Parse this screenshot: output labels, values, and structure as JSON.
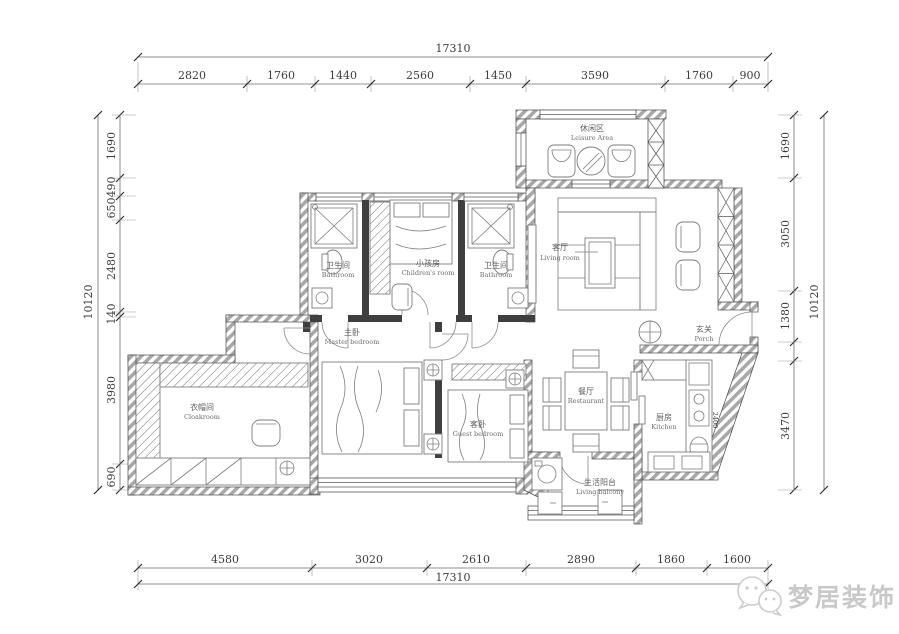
{
  "drawing": {
    "type": "residential floor plan"
  },
  "dims": {
    "top": {
      "total": "17310",
      "segments": [
        "2820",
        "1760",
        "1440",
        "2560",
        "1450",
        "3590",
        "1760",
        "900"
      ]
    },
    "bottom": {
      "total": "17310",
      "segments": [
        "4580",
        "3020",
        "2610",
        "2890",
        "1860",
        "1600"
      ]
    },
    "left": {
      "total": "10120",
      "segments": [
        "1690",
        "490",
        "650",
        "2480",
        "140",
        "3980",
        "690"
      ]
    },
    "right": {
      "total": "10120",
      "segments": [
        "1690",
        "3050",
        "1380",
        "3470"
      ]
    },
    "kitchen_counter": "2400"
  },
  "rooms": {
    "leisure": {
      "zh": "休闲区",
      "en": "Leisure Area"
    },
    "living": {
      "zh": "客厅",
      "en": "Living room"
    },
    "porch": {
      "zh": "玄关",
      "en": "Porch"
    },
    "bath_left": {
      "zh": "卫生间",
      "en": "Bathroom"
    },
    "children": {
      "zh": "小孩房",
      "en": "Children's room"
    },
    "bath_right": {
      "zh": "卫生间",
      "en": "Bathroom"
    },
    "master": {
      "zh": "主卧",
      "en": "Master bedroom"
    },
    "cloakroom": {
      "zh": "衣帽间",
      "en": "Cloakroom"
    },
    "guest": {
      "zh": "客卧",
      "en": "Guest bedroom"
    },
    "dining": {
      "zh": "餐厅",
      "en": "Restaurant"
    },
    "kitchen": {
      "zh": "厨房",
      "en": "Kitchen"
    },
    "balcony": {
      "zh": "生活阳台",
      "en": "Living balcony"
    }
  },
  "brand": {
    "name": "梦居装饰"
  },
  "colors": {
    "wall": "#3f3f3f",
    "dim_text": "#3c3c3c",
    "room_text": "#666666",
    "brand": "#c9c9c9"
  }
}
